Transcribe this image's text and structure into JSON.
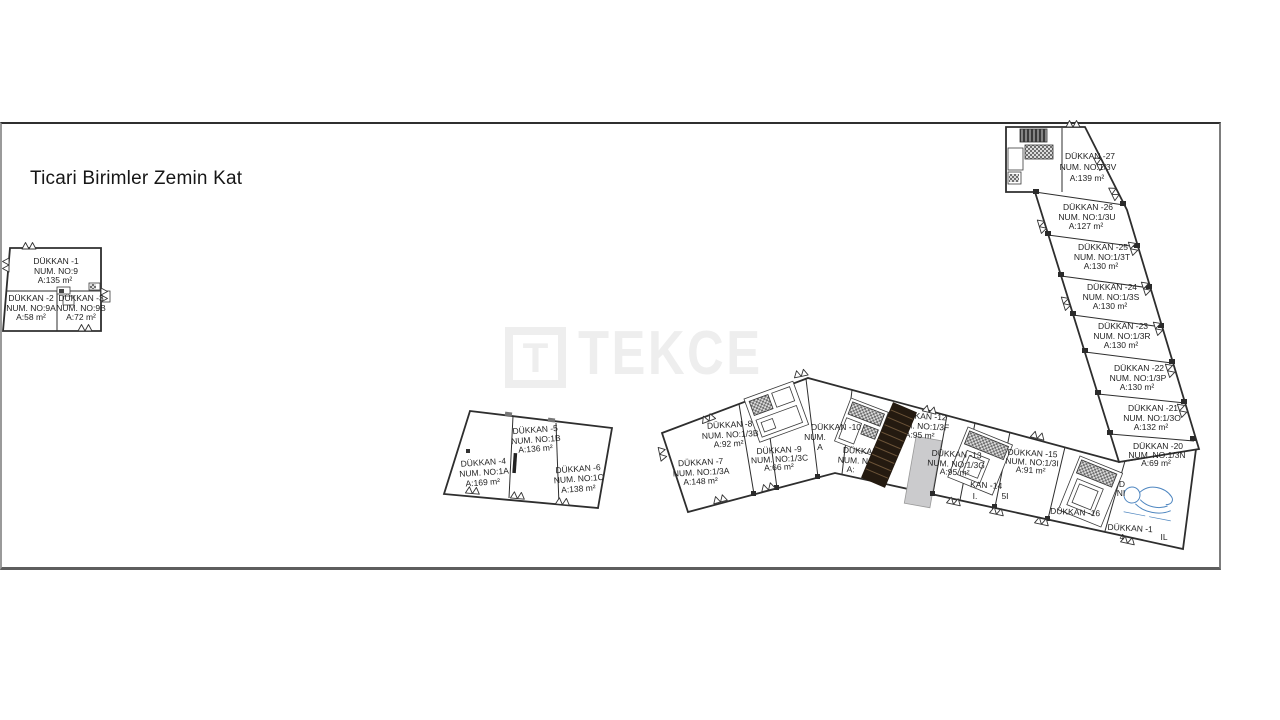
{
  "title": "Ticari Birimler Zemin Kat",
  "watermark": {
    "logo_letter": "T",
    "text": "TEKCE"
  },
  "colors": {
    "wall": "#2e2e2e",
    "label": "#1f1f1f",
    "watermark_gray": "#eeeeee",
    "ramp_fill": "#cbcbcd",
    "stair_dark": "#241a10",
    "stamp_blue": "#4e86c0"
  },
  "units": {
    "u1": {
      "name": "DÜKKAN -1",
      "num": "NUM. NO:9",
      "area": "A:135 m²"
    },
    "u2": {
      "name": "DÜKKAN -2",
      "num": "NUM. NO:9A",
      "area": "A:58 m²"
    },
    "u3": {
      "name": "DÜKKAN -3",
      "num": "NUM. NO:9B",
      "area": "A:72 m²"
    },
    "u4": {
      "name": "DÜKKAN -4",
      "num": "NUM. NO:1A",
      "area": "A:169 m²"
    },
    "u5": {
      "name": "DÜKKAN -5",
      "num": "NUM. NO:1B",
      "area": "A:136 m²"
    },
    "u6": {
      "name": "DÜKKAN -6",
      "num": "NUM. NO:1C",
      "area": "A:138 m²"
    },
    "u7": {
      "name": "DÜKKAN -7",
      "num": "NUM. NO:1/3A",
      "area": "A:148 m²"
    },
    "u8": {
      "name": "DÜKKAN -8",
      "num": "NUM. NO:1/3B",
      "area": "A:92 m²"
    },
    "u9": {
      "name": "DÜKKAN -9",
      "num": "NUM. NO:1/3C",
      "area": "A:66 m²"
    },
    "u10": {
      "name": "DÜKKAN -10",
      "num": "NUM.",
      "area": "A"
    },
    "u11": {
      "name": "DÜKKAN -11",
      "num": "NUM. NO:1/3E",
      "area": "A:"
    },
    "u12": {
      "name": "DÜKKAN -12",
      "num": "NUM. NO:1/3F",
      "area": "A:95 m²"
    },
    "u13": {
      "name": "DÜKKAN -13",
      "num": "NUM. NO:1/3G",
      "area": "A:95 m²"
    },
    "u14": {
      "name": "KAN -14",
      "num": "I.",
      "area": "5I"
    },
    "u15": {
      "name": "DÜKKAN -15",
      "num": "NUM. NO:1/3I",
      "area": "A:91 m²"
    },
    "u16": {
      "name": "DÜKKAN -16"
    },
    "u17": {
      "name": "DÜKKAN -1",
      "frag_a": "4",
      "frag_b": "IL"
    },
    "u20": {
      "name": "DÜKKAN -20",
      "num": "NUM. NO:1/3N",
      "area": "A:69 m²"
    },
    "u21": {
      "name": "DÜKKAN -21",
      "num": "NUM. NO:1/3O",
      "area": "A:132 m²"
    },
    "u22": {
      "name": "DÜKKAN -22",
      "num": "NUM. NO:1/3P",
      "area": "A:130 m²"
    },
    "u23": {
      "name": "DÜKKAN -23",
      "num": "NUM. NO:1/3R",
      "area": "A:130 m²"
    },
    "u24": {
      "name": "DÜKKAN -24",
      "num": "NUM. NO:1/3S",
      "area": "A:130 m²"
    },
    "u25": {
      "name": "DÜKKAN -25",
      "num": "NUM. NO:1/3T",
      "area": "A:130 m²"
    },
    "u26": {
      "name": "DÜKKAN -26",
      "num": "NUM. NO:1/3U",
      "area": "A:127 m²"
    },
    "u27": {
      "name": "DÜKKAN -27",
      "num": "NUM. NO:1/3V",
      "area": "A:139 m²"
    }
  },
  "fragments": {
    "d": "D",
    "ni": "NI"
  }
}
